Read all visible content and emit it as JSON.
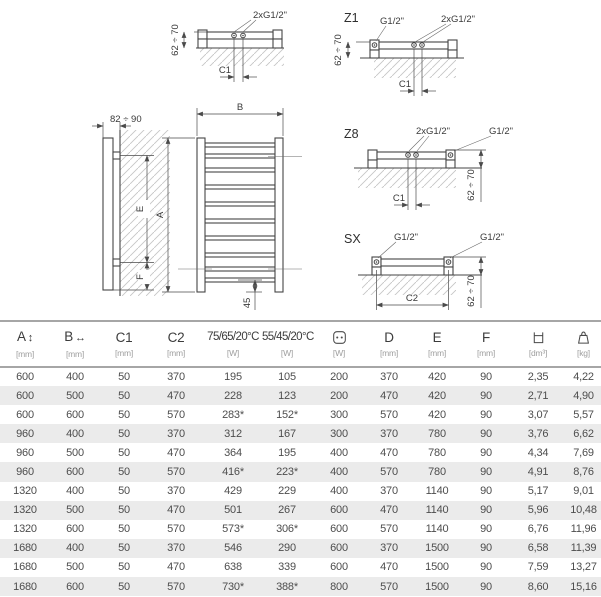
{
  "diagrams": {
    "top_plain": {
      "conn_center": "2xG1/2\"",
      "dim_wall": "62 ÷ 70",
      "dim_c": "C1"
    },
    "z1": {
      "label": "Z1",
      "conn_side": "G1/2\"",
      "conn_center": "2xG1/2\"",
      "dim_wall": "62 ÷ 70",
      "dim_c": "C1"
    },
    "z8": {
      "label": "Z8",
      "conn_center": "2xG1/2\"",
      "conn_side": "G1/2\"",
      "dim_wall": "62 ÷ 70",
      "dim_c": "C1"
    },
    "sx": {
      "label": "SX",
      "conn_left": "G1/2\"",
      "conn_right": "G1/2\"",
      "dim_wall": "62 ÷ 70",
      "dim_c": "C2"
    },
    "side": {
      "dim_depth": "82 ÷ 90",
      "dim_e": "E",
      "dim_f": "F"
    },
    "front": {
      "dim_width": "B",
      "dim_height": "A",
      "dim_bottom": "45"
    }
  },
  "table": {
    "columns": [
      {
        "label": "A",
        "symbol": "↕",
        "unit": "[mm]"
      },
      {
        "label": "B",
        "symbol": "↔",
        "unit": "[mm]"
      },
      {
        "label": "C1",
        "symbol": "",
        "unit": "[mm]"
      },
      {
        "label": "C2",
        "symbol": "",
        "unit": "[mm]"
      },
      {
        "label": "75/65/20°C",
        "symbol": "",
        "unit": "[W]"
      },
      {
        "label": "55/45/20°C",
        "symbol": "",
        "unit": "[W]"
      },
      {
        "label": "",
        "icon": "power-socket",
        "unit": "[W]"
      },
      {
        "label": "D",
        "symbol": "",
        "unit": "[mm]"
      },
      {
        "label": "E",
        "symbol": "",
        "unit": "[mm]"
      },
      {
        "label": "F",
        "symbol": "",
        "unit": "[mm]"
      },
      {
        "label": "",
        "icon": "water-volume",
        "unit": "[dm³]"
      },
      {
        "label": "",
        "icon": "weight",
        "unit": "[kg]"
      }
    ],
    "rows": [
      [
        "600",
        "400",
        "50",
        "370",
        "195",
        "105",
        "200",
        "370",
        "420",
        "90",
        "2,35",
        "4,22"
      ],
      [
        "600",
        "500",
        "50",
        "470",
        "228",
        "123",
        "200",
        "470",
        "420",
        "90",
        "2,71",
        "4,90"
      ],
      [
        "600",
        "600",
        "50",
        "570",
        "283*",
        "152*",
        "300",
        "570",
        "420",
        "90",
        "3,07",
        "5,57"
      ],
      [
        "960",
        "400",
        "50",
        "370",
        "312",
        "167",
        "300",
        "370",
        "780",
        "90",
        "3,76",
        "6,62"
      ],
      [
        "960",
        "500",
        "50",
        "470",
        "364",
        "195",
        "400",
        "470",
        "780",
        "90",
        "4,34",
        "7,69"
      ],
      [
        "960",
        "600",
        "50",
        "570",
        "416*",
        "223*",
        "400",
        "570",
        "780",
        "90",
        "4,91",
        "8,76"
      ],
      [
        "1320",
        "400",
        "50",
        "370",
        "429",
        "229",
        "400",
        "370",
        "1140",
        "90",
        "5,17",
        "9,01"
      ],
      [
        "1320",
        "500",
        "50",
        "470",
        "501",
        "267",
        "600",
        "470",
        "1140",
        "90",
        "5,96",
        "10,48"
      ],
      [
        "1320",
        "600",
        "50",
        "570",
        "573*",
        "306*",
        "600",
        "570",
        "1140",
        "90",
        "6,76",
        "11,96"
      ],
      [
        "1680",
        "400",
        "50",
        "370",
        "546",
        "290",
        "600",
        "370",
        "1500",
        "90",
        "6,58",
        "11,39"
      ],
      [
        "1680",
        "500",
        "50",
        "470",
        "638",
        "339",
        "600",
        "470",
        "1500",
        "90",
        "7,59",
        "13,27"
      ],
      [
        "1680",
        "600",
        "50",
        "570",
        "730*",
        "388*",
        "800",
        "570",
        "1500",
        "90",
        "8,60",
        "15,16"
      ]
    ]
  }
}
